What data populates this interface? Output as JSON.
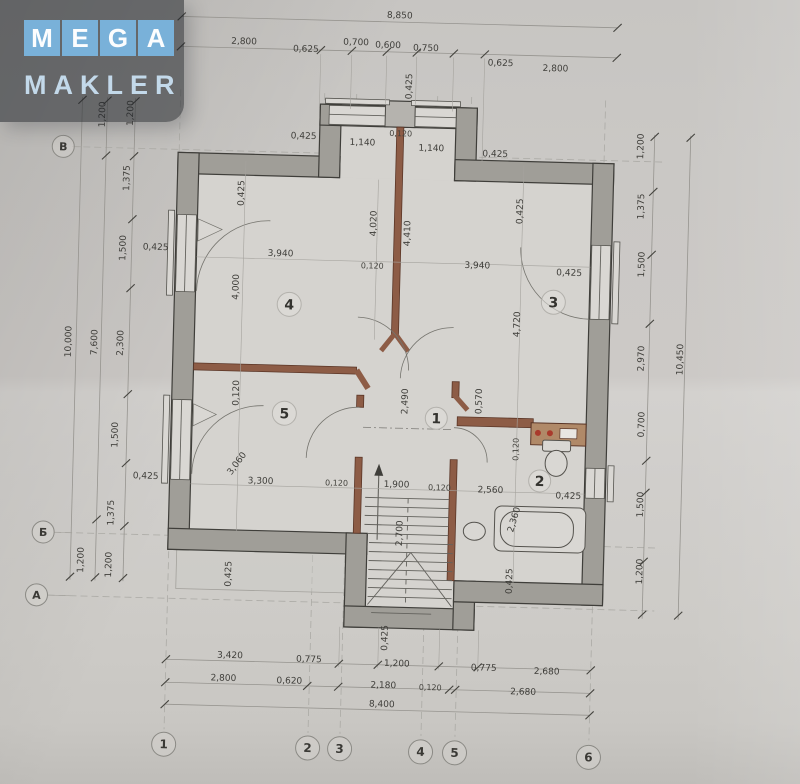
{
  "watermark": {
    "tiles": [
      "M",
      "E",
      "G",
      "A"
    ],
    "word": "MAKLER"
  },
  "axes": {
    "rows": [
      "В",
      "Б",
      "А"
    ],
    "cols": [
      "1",
      "2",
      "3",
      "4",
      "5",
      "6"
    ]
  },
  "rooms": {
    "hall": "1",
    "bath": "2",
    "r3": "3",
    "r4": "4",
    "r5": "5"
  },
  "dims": {
    "top_total": "8,850",
    "top_chain": [
      "2,800",
      "0,625",
      "0,700",
      "0,600",
      "0,750",
      "0,625",
      "2,800"
    ],
    "top_inner": {
      "chimney": "0,425",
      "left_wall": "0,425",
      "left_win": "1,140",
      "pier": "0,120",
      "right_win": "1,140",
      "right_wall": "0,425"
    },
    "left": {
      "outer": "10,000",
      "mid": [
        "1,200",
        "7,600",
        "1,200"
      ],
      "chain": [
        "1,200",
        "1,375",
        "1,500",
        "2,300",
        "1,500",
        "1,375",
        "1,200"
      ],
      "wall_top": "0,425",
      "wall_bot": "0,425"
    },
    "right": {
      "outer": "10,450",
      "chain": [
        "1,200",
        "1,375",
        "1,500",
        "2,970",
        "0,700",
        "1,500",
        "1,200"
      ]
    },
    "bottom": {
      "chain1": [
        "3,420",
        "0,775",
        "1,200",
        "0,775",
        "2,680"
      ],
      "chain2": [
        "2,800",
        "0,620",
        "2,180",
        "0,120",
        "2,680"
      ],
      "total": "8,400",
      "porch": "0,425"
    },
    "room4": {
      "width": "3,940",
      "height": "4,000",
      "wall": "0,425",
      "center": "4,020",
      "thickness": "0,120"
    },
    "room3": {
      "width": "3,940",
      "height": "4,720",
      "wall": "0,425",
      "center": "4,410",
      "side_wall": "0,425"
    },
    "room5": {
      "width": "3,300",
      "depth": "3,060",
      "thickness": "0,120",
      "bottom_wall": "0,425"
    },
    "hall": {
      "width": "1,900",
      "depth": "2,490",
      "stair": "2,700",
      "t_left": "0,120",
      "t_right": "0,120",
      "porch_wall": "0,425"
    },
    "room2": {
      "width": "2,560",
      "depth": "2,360",
      "stub": "0,570",
      "thickness": "0,120",
      "wall": "0,425"
    }
  }
}
